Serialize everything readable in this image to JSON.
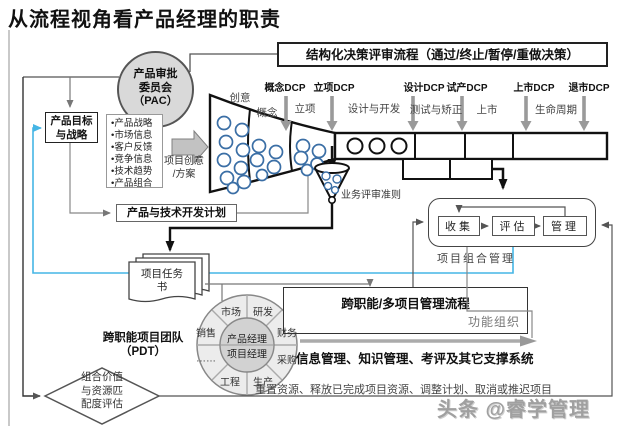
{
  "title": "从流程视角看产品经理的职责",
  "banner": "结构化决策评审流程（通过/终止/暂停/重做决策）",
  "pac": {
    "l1": "产品审批",
    "l2": "委员会",
    "l3": "（PAC）"
  },
  "dcp_labels": [
    "概念DCP",
    "立项DCP",
    "设计DCP",
    "试产DCP",
    "上市DCP",
    "退市DCP"
  ],
  "phases": [
    "创意",
    "概念",
    "立项",
    "设计与开发",
    "测试与矫正",
    "上市",
    "生命周期"
  ],
  "strategy": {
    "l1": "产品目标",
    "l2": "与战略"
  },
  "inputs": [
    "•产品战略",
    "•市场信息",
    "•客户反馈",
    "•竞争信息",
    "•技术趋势",
    "•产品组合"
  ],
  "idea": {
    "l1": "项目创意",
    "l2": "/方案"
  },
  "plan_box": "产品与技术开发计划",
  "review_criteria": "业务评审准则",
  "task_doc": {
    "l1": "项目任务",
    "l2": "书"
  },
  "portfolio": {
    "collect": "收集",
    "evaluate": "评估",
    "manage": "管理",
    "label": "项目组合管理"
  },
  "pdt": {
    "title1": "跨职能项目团队",
    "title2": "（PDT）",
    "center1": "产品经理",
    "center2": "项目经理",
    "segments": [
      "市场",
      "研发",
      "财务",
      "采购",
      "生产",
      "工程",
      "……",
      "销售"
    ]
  },
  "crossfunc": {
    "title": "跨职能/多项目管理流程",
    "org": "功能组织"
  },
  "support_text": "信息管理、知识管理、考评及其它支撑系统",
  "bottom_text": "重置资源、释放已完成项目资源、调整计划、取消或推迟项目",
  "diamond": {
    "l1": "组合价值",
    "l2": "与资源匹",
    "l3": "配度评估"
  },
  "watermark": "头条 @睿学管理",
  "colors": {
    "cyan": "#45b5e5",
    "gray_arrow": "#9a9a9a",
    "blue_circle": "#3a6ea5",
    "pac_fill": "#d9d9d9"
  }
}
